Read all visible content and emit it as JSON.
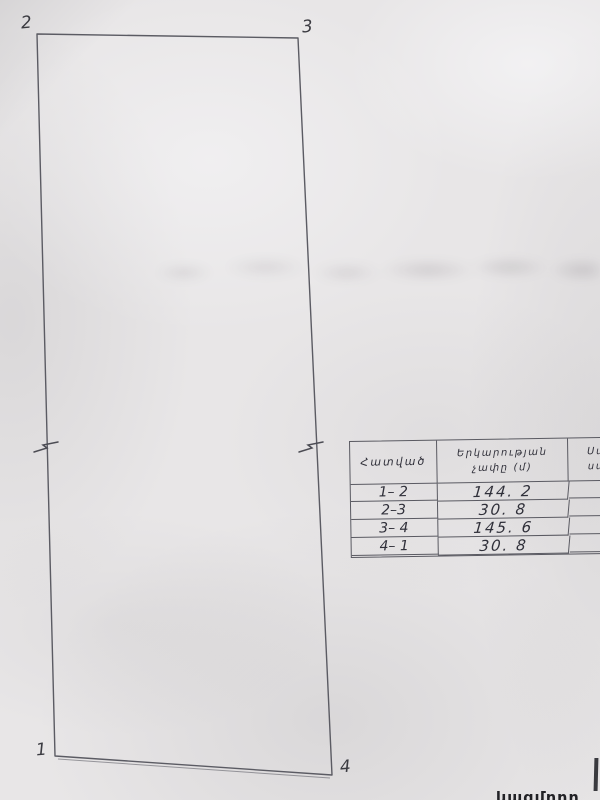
{
  "paper": {
    "background": "#e8e6e7",
    "ink": "#30303a",
    "line_color": "#5a5a62"
  },
  "sketch": {
    "corners": {
      "tl": "2",
      "tr": "3",
      "bl": "1",
      "br": "4"
    }
  },
  "table": {
    "header": {
      "segment": "Հատված",
      "length_line1": "Երկարության",
      "length_line2": "չափը (մ)",
      "adjacent_line1": "Սահմ",
      "adjacent_line2": "սահմ"
    },
    "rows": [
      {
        "a": "1",
        "b": "– 2",
        "len": "144. 2",
        "adj": "Ա"
      },
      {
        "a": "2",
        "b": "–3",
        "len": "30. 8",
        "adj": "Ձ"
      },
      {
        "a": "3",
        "b": "– 4",
        "len": "145. 6",
        "adj": "Վ"
      },
      {
        "a": "4",
        "b": "– 1",
        "len": "30. 8",
        "adj": "Հ"
      }
    ]
  },
  "footer": {
    "cutoff_text": "կազմողը"
  }
}
